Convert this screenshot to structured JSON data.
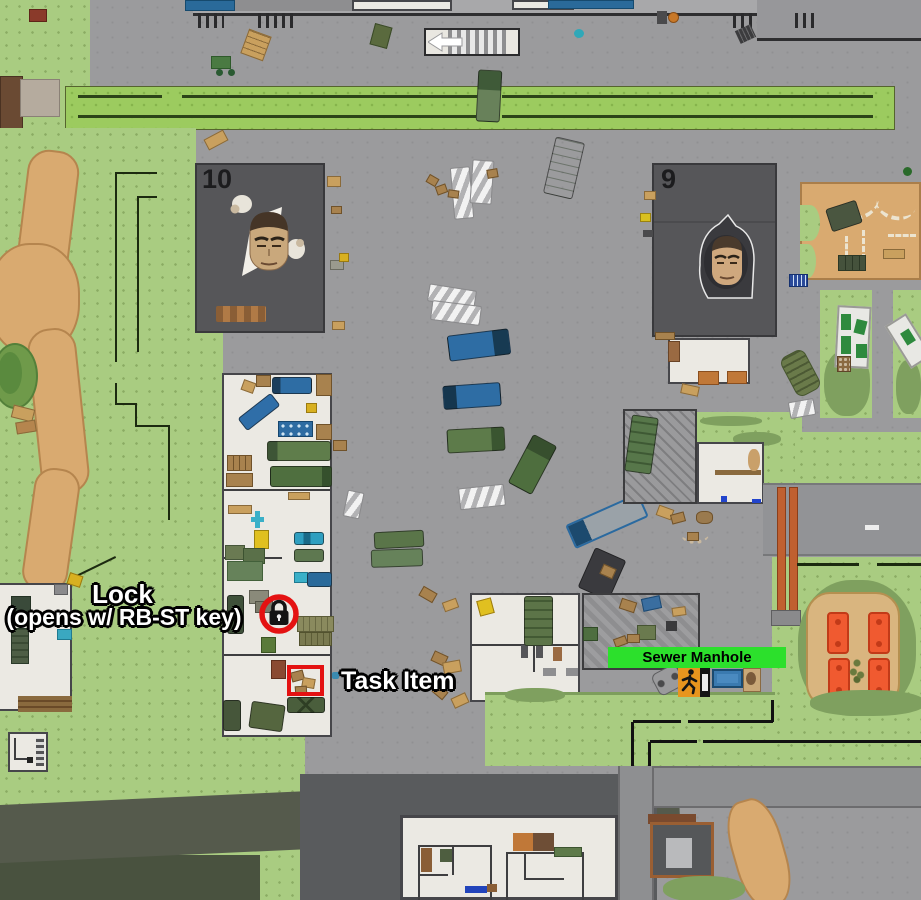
{
  "map_annotations": {
    "lock_label": {
      "line1": "Lock",
      "line2": "(opens w/ RB-ST key)"
    },
    "task_item_label": "Task Item",
    "sewer_manhole_label": "Sewer Manhole"
  },
  "buildings": {
    "building_10": {
      "number": "10"
    },
    "building_9": {
      "number": "9"
    }
  },
  "colors": {
    "annotation_red": "#e41212",
    "sewer_bar_green": "#2ce02c",
    "sewer_bar_text": "#000000",
    "exit_icon_orange": "#e8951e",
    "grass_green": "#a9cc81",
    "pavement_gray": "#9b9b9d",
    "dirt_tan": "#d9aa70",
    "dark_building_gray": "#565659",
    "playground_bed_orange": "#f05a30"
  },
  "icons": [
    "lock-icon",
    "exit-runner-icon",
    "left-arrow-icon",
    "trader-face-10-icon",
    "trader-face-9-icon"
  ]
}
